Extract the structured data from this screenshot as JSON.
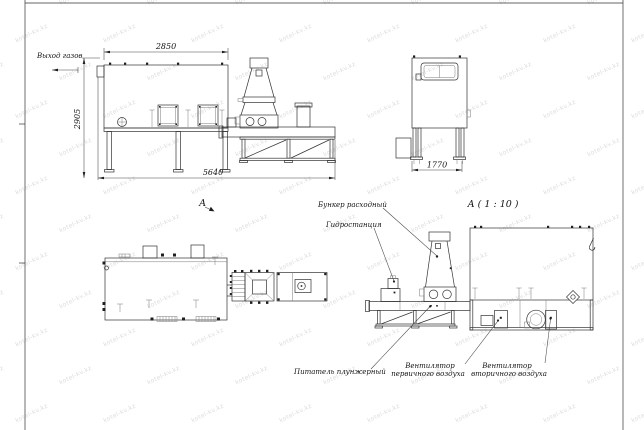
{
  "watermark": {
    "text": "kotel-kv.kz",
    "color": "#dcdcdc"
  },
  "drawing": {
    "line_color": "#333333",
    "labels": {
      "gas_outlet": "Выход газов",
      "hopper": "Бункер расходный",
      "hydro": "Гидростанция",
      "feeder": "Питатель плунжерный",
      "fan1_line1": "Вентилятор",
      "fan1_line2": "первичного воздуха",
      "fan2_line1": "Вентилятор",
      "fan2_line2": "вторичного воздуха",
      "section_marker": "А",
      "section_title": "А ( 1 : 10 )"
    },
    "dimensions": {
      "front_top_width": "2850",
      "front_height": "2905",
      "front_total_length": "5640",
      "side_width": "1770"
    }
  }
}
